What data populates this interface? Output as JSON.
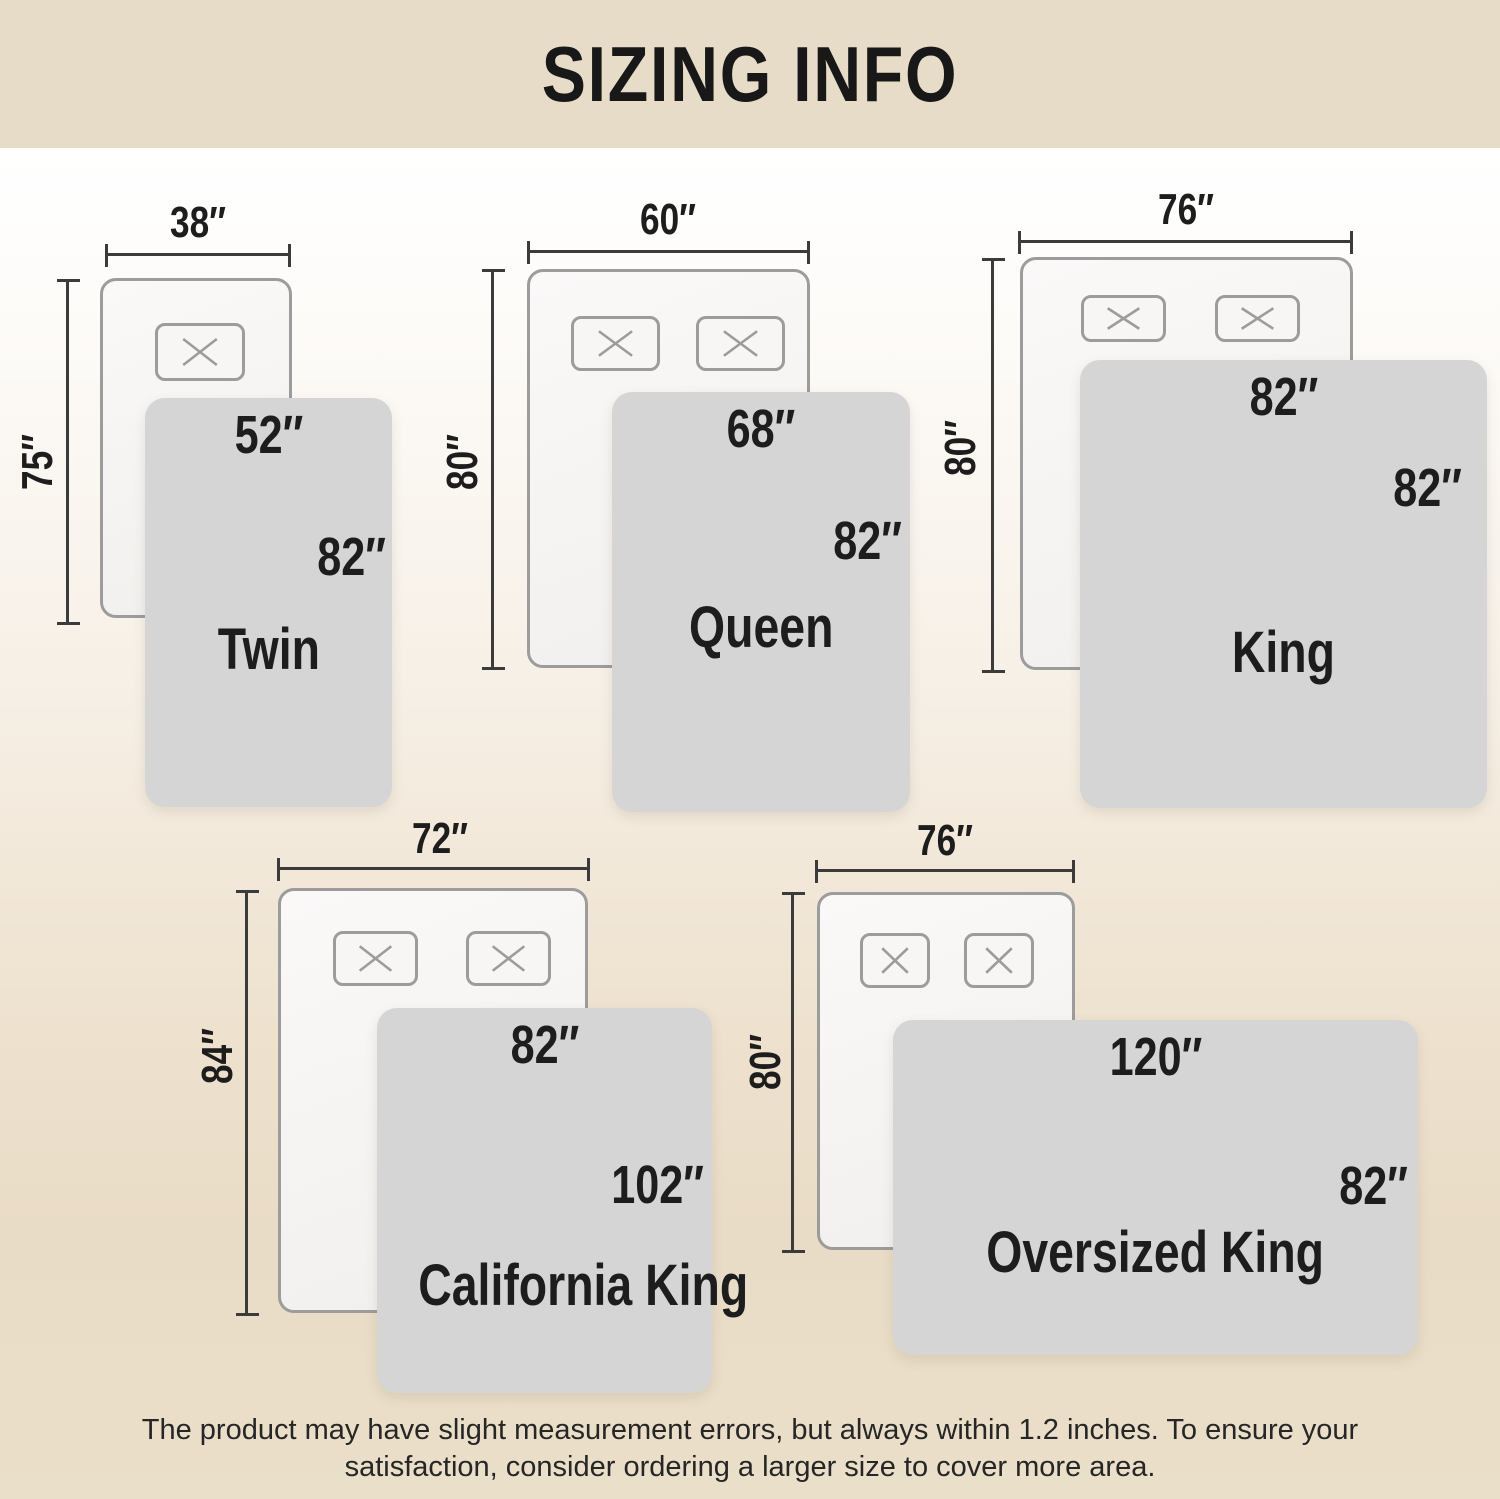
{
  "title": "SIZING INFO",
  "disclaimer": {
    "line1": "The product may have slight measurement errors, but always within 1.2 inches. To ensure your",
    "line2": "satisfaction, consider ordering a larger size to cover more area."
  },
  "colors": {
    "banner_bg": "#e7dcc7",
    "page_top": "#ffffff",
    "page_bottom": "#eadfc9",
    "blanket_fill": "#d5d5d5",
    "bed_fill": "#f8f7f6",
    "outline_gray": "#9c9c9c",
    "dimension_line": "#3b3b3b",
    "text_dark": "#1d1d1d"
  },
  "sizes": [
    {
      "name": "Twin",
      "mattress_width": "38″",
      "mattress_length": "75″",
      "blanket_width": "52″",
      "blanket_length": "82″",
      "pillow_count": 1
    },
    {
      "name": "Queen",
      "mattress_width": "60″",
      "mattress_length": "80″",
      "blanket_width": "68″",
      "blanket_length": "82″",
      "pillow_count": 2
    },
    {
      "name": "King",
      "mattress_width": "76″",
      "mattress_length": "80″",
      "blanket_width": "82″",
      "blanket_length": "82″",
      "pillow_count": 2
    },
    {
      "name": "California King",
      "mattress_width": "72″",
      "mattress_length": "84″",
      "blanket_width": "82″",
      "blanket_length": "102″",
      "pillow_count": 2
    },
    {
      "name": "Oversized King",
      "mattress_width": "76″",
      "mattress_length": "80″",
      "blanket_width": "120″",
      "blanket_length": "82″",
      "pillow_count": 2
    }
  ]
}
